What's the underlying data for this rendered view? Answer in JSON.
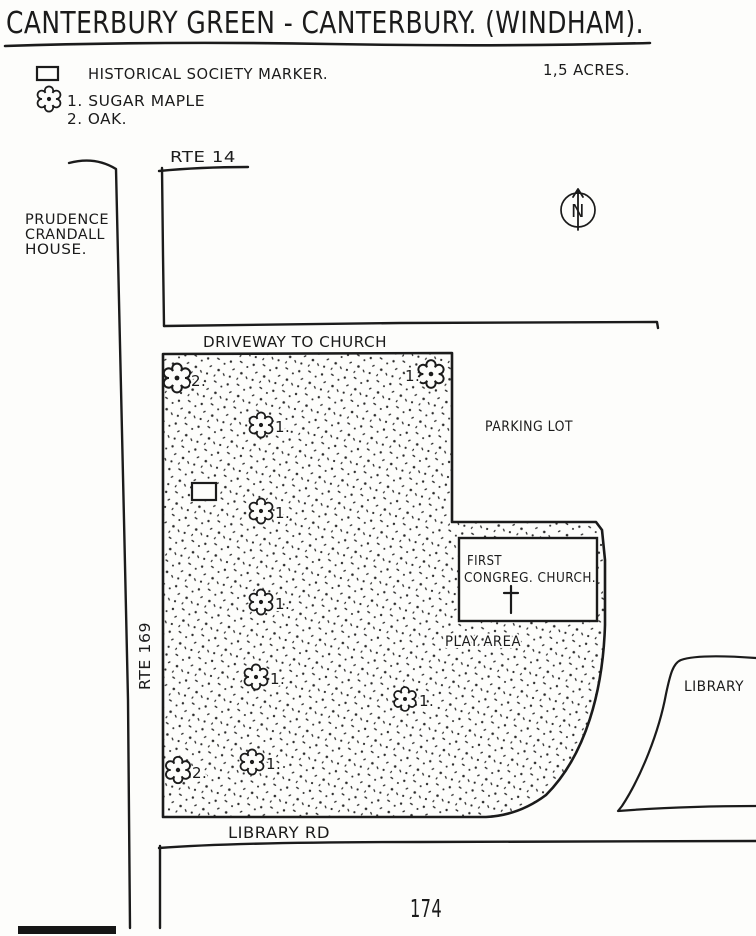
{
  "title": "CANTERBURY GREEN - CANTERBURY. (WINDHAM).",
  "legend": {
    "marker_label": "HISTORICAL SOCIETY MARKER.",
    "acreage": "1,5 ACRES.",
    "tree1": "1. SUGAR MAPLE",
    "tree2": "2. OAK."
  },
  "roads": {
    "rte14": "RTE 14",
    "rte169": "RTE 169",
    "library_rd": "LIBRARY RD",
    "driveway": "DRIVEWAY TO CHURCH"
  },
  "places": {
    "prudence_line1": "PRUDENCE",
    "prudence_line2": "CRANDALL",
    "prudence_line3": "HOUSE.",
    "parking_lot": "PARKING LOT",
    "church_line1": "FIRST",
    "church_line2": "CONGREG. CHURCH.",
    "play_area": "PLAY AREA",
    "library": "LIBRARY"
  },
  "compass": {
    "north": "N"
  },
  "page_number": "174",
  "map_trees": [
    {
      "species": "oak",
      "label": "2.",
      "x": 177,
      "y": 378,
      "dx": 14,
      "dy": 8,
      "scale": 1.15
    },
    {
      "species": "sugar-maple",
      "label": "1.",
      "x": 431,
      "y": 374,
      "dx": -26,
      "dy": 7,
      "scale": 1.1
    },
    {
      "species": "sugar-maple",
      "label": "1.",
      "x": 261,
      "y": 425,
      "dx": 14,
      "dy": 7,
      "scale": 1
    },
    {
      "species": "sugar-maple",
      "label": "1.",
      "x": 261,
      "y": 511,
      "dx": 14,
      "dy": 7,
      "scale": 1
    },
    {
      "species": "sugar-maple",
      "label": "1.",
      "x": 261,
      "y": 602,
      "dx": 14,
      "dy": 7,
      "scale": 1
    },
    {
      "species": "sugar-maple",
      "label": "1.",
      "x": 256,
      "y": 677,
      "dx": 14,
      "dy": 7,
      "scale": 1
    },
    {
      "species": "sugar-maple",
      "label": "1.",
      "x": 405,
      "y": 699,
      "dx": 14,
      "dy": 7,
      "scale": 0.95
    },
    {
      "species": "sugar-maple",
      "label": "1.",
      "x": 252,
      "y": 762,
      "dx": 14,
      "dy": 7,
      "scale": 1
    },
    {
      "species": "oak",
      "label": "2.",
      "x": 178,
      "y": 770,
      "dx": 14,
      "dy": 8,
      "scale": 1.05
    }
  ],
  "colors": {
    "ink": "#1b1b1b",
    "paper": "#fdfdfb",
    "stipple": "#2b2b2b"
  }
}
